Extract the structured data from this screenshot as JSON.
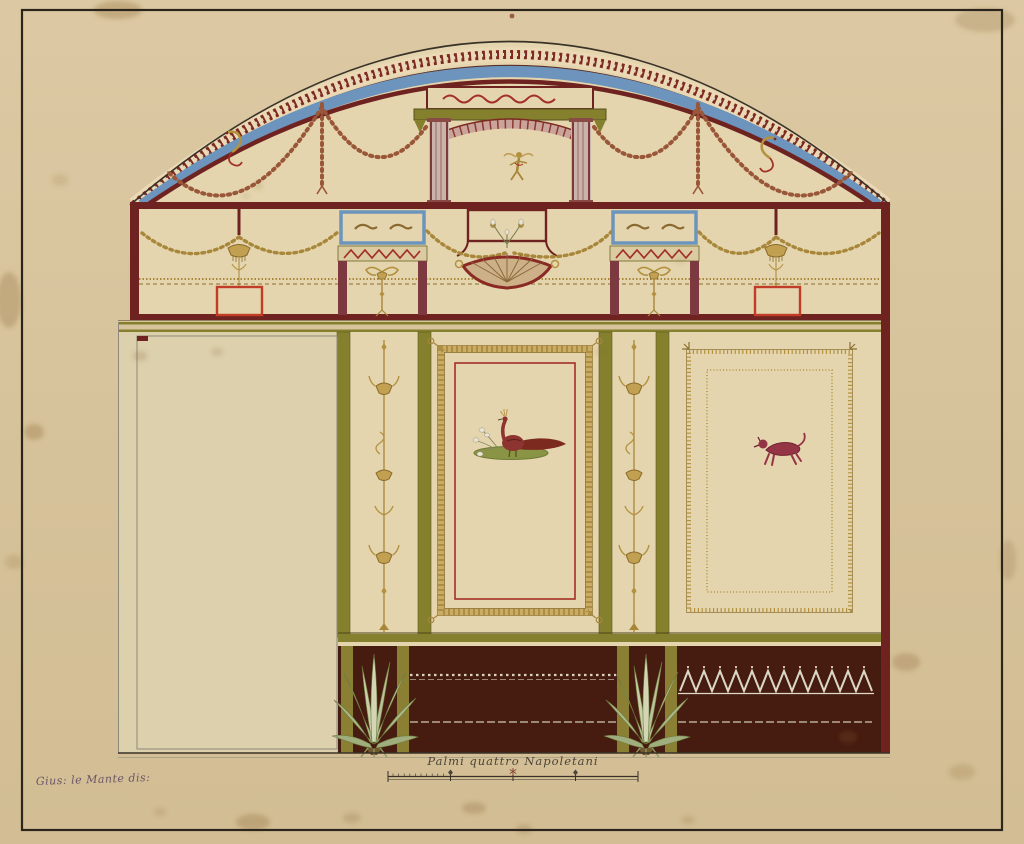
{
  "artwork": {
    "signature": "Gius: le Mante dis:",
    "scale_label": "Palmi quattro Napoletani"
  },
  "scale_bar": {
    "length_palmi": 4,
    "major_ticks": 5
  },
  "palette": {
    "paper": "#d8c5a0",
    "paper_edge": "#dfcda8",
    "cream": "#e4d5ae",
    "cream_left": "#dcd0ad",
    "maroon": "#6e2320",
    "dark_line": "#3a3228",
    "blue": "#6d94bc",
    "olive": "#85802e",
    "olive_bright": "#8a7f33",
    "gold": "#a8863a",
    "gold_light": "#c9ad67",
    "dado": "#471c10",
    "red": "#c23d28",
    "pink": "#caa49a",
    "leaf": "#b9c296",
    "white_detail": "#ded8c6",
    "ink": "#4a443a",
    "signature_ink": "#6b5668",
    "stain": "#8a6632"
  }
}
